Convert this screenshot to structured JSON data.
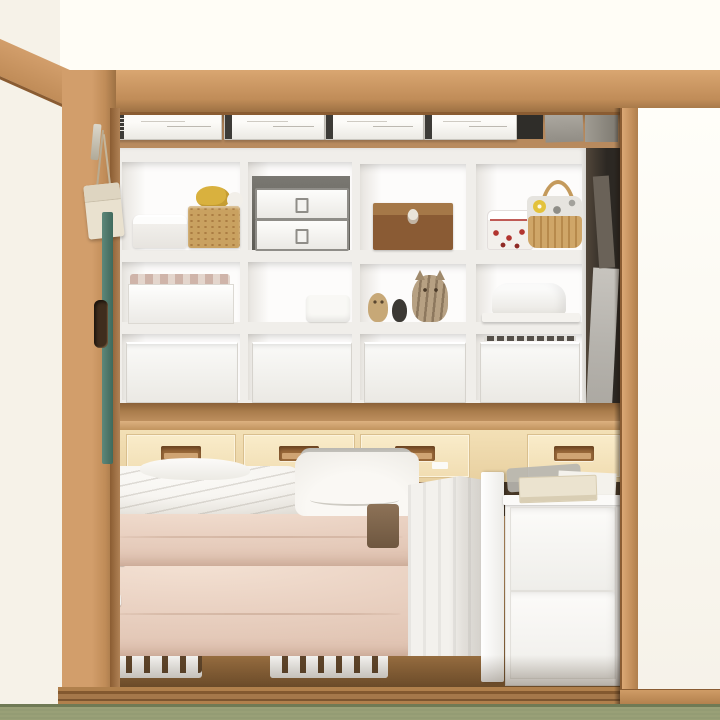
{
  "scene": {
    "type": "photograph",
    "description": "Japanese closet (oshiire) with right sliding door open, revealing a white cube shelving unit topped with slim label boxes, a row of built-in light wooden drawers with recessed pulls, and a lower bay holding folded futon bedding on white slatted pallets next to a white plastic drawer unit, all above a tatami floor",
    "room": "tatami room with white walls and natural wood trim"
  },
  "palette": {
    "wall": "#f6f2e8",
    "wall_upper": "#fffdf6",
    "wood_light": "#d29e6b",
    "wood_mid": "#c08c58",
    "wood_dark": "#9d7143",
    "wood_deep": "#8a5c32",
    "back_wood": "#b2855a",
    "back_wood_shadow": "#7e5c38",
    "counter_dark": "#8a6138",
    "counter_light": "#dcb180",
    "drawer_face": "#f3e0b6",
    "drawer_face_deep": "#e8d0a0",
    "handle_light": "#cfa473",
    "shelf_white": "#f0eeea",
    "compartment_white": "#fdfcfb",
    "compartment_shade": "#e7e4df",
    "bin_light": "#fafaf8",
    "bin_deep": "#ebe9e4",
    "box_border": "#c9c6bf",
    "cap_dark": "#3d3b37",
    "metal_grey": "#8f8d88",
    "grey_box_light": "#7a7872",
    "grey_box_dark": "#5d5b55",
    "wood_box_light": "#a57848",
    "wood_box_dark": "#8a5b34",
    "cork": "#c9a160",
    "cork_dot": "#ab7d43",
    "duck_yellow": "#d9b13e",
    "red_dot": "#b23530",
    "wicker_light": "#cfa668",
    "wicker_dark": "#b78a4c",
    "cloth_grey": "#9b9a94",
    "flower_yellow": "#e3c23c",
    "owl_tan": "#c7a877",
    "figure_black": "#3c3934",
    "cat_tan": "#b7a183",
    "teal": "#4c7467",
    "pouch_canvas": "#e9e1cf",
    "futon_pink": "#ecd5c6",
    "futon_pink_deep": "#e2c6b5",
    "futon_pink_light": "#f4e2d4",
    "duvet_white": "#f7f5f1",
    "duvet_shade": "#dcd8d0",
    "pillow_fold": "#b9b7b1",
    "pallet_white": "#f4f3f0",
    "pallet_gap": "#5f452a",
    "cover_white": "#f3f1ed",
    "cover_shade": "#d4d1cb",
    "unit_white": "#f6f5f2",
    "book_cream": "#ebe3cf",
    "bag_grey": "#b7b6b0",
    "brown_pouch": "#8d7257",
    "lower_wood": "#c99d6e",
    "lower_wood_deep": "#855d33",
    "dark_gap": "#2c2823",
    "gap_item": "#b5b2ac",
    "rail_light": "#b0804c",
    "rail_dark": "#83592f",
    "tatami": "#99a077",
    "tatami_dark": "#6f7a55",
    "door_white": "#fffef9"
  },
  "objects": {
    "top_shelf": {
      "slim_label_boxes": 4,
      "dark_box": 1,
      "grey_boxes": 2
    },
    "shelf_unit": {
      "columns": 4,
      "rows": 3,
      "row1": [
        "white lidded container",
        "cork basket with yellow duck toy and knit ball",
        "grey box with two white metal latch boxes",
        "wooden keepsake box with owl emblem",
        "red-dotted canister",
        "wicker basket with patterned cloth and handle"
      ],
      "row2": [
        "white tray box with folded fabric",
        "small white box",
        "owl figurine",
        "black figurine",
        "striped cat figurine",
        "white appliance cover on board"
      ],
      "row3": [
        "white storage bin",
        "white storage bin",
        "white storage bin",
        "white storage bin with dark edge"
      ]
    },
    "drawer_row": {
      "wooden_drawers": 4,
      "recessed_handles": 4,
      "label_tag": 1
    },
    "lower_bay": [
      "white duvet",
      "white pillow",
      "two pink folded futons",
      "two white slatted pallets",
      "white fabric-covered item",
      "white divider panel",
      "two-drawer plastic unit",
      "cream notebook",
      "white paper",
      "grey plastic bag",
      "brown pouch"
    ],
    "left_side": [
      "hanging canvas pouch on cords",
      "teal leaning board",
      "recessed pull on pillar"
    ],
    "right_side": [
      "white sliding door with wooden stile",
      "dark gap with leaning grey items"
    ],
    "floor": [
      "wooden threshold rail",
      "green tatami"
    ]
  }
}
